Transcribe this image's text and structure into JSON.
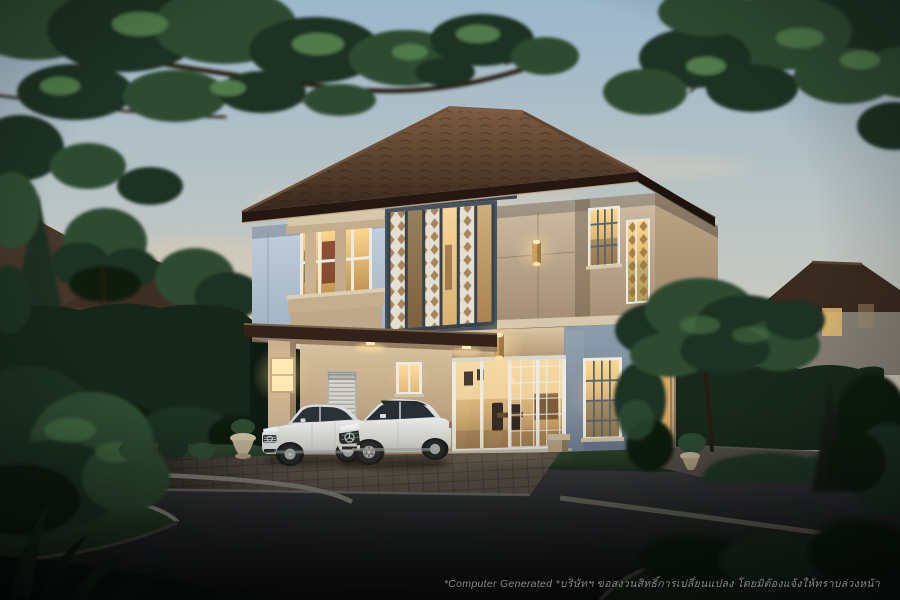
{
  "watermark": {
    "text": "*Computer Generated *บริษัทฯ ขอสงวนสิทธิ์การเปลี่ยนแปลง โดยมิต้องแจ้งให้ทราบล่วงหน้า"
  },
  "colors": {
    "sky_top": "#9cb7cb",
    "sky_mid": "#c3c8c2",
    "sky_horizon": "#e7d1b5",
    "sky_horizon_deep": "#eed8bc",
    "roof_light": "#7e5d41",
    "roof_dark": "#38271b",
    "roof_right_light": "#503a29",
    "roof_right_dark": "#241710",
    "fascia_brown": "#261811",
    "wall_blue": "#c7d3df",
    "wall_blue_deep": "#9eb0c1",
    "wall_beige": "#d1c0a6",
    "wall_beige_deep": "#a18a71",
    "wall_beige_ground": "#dcc6a4",
    "wall_beige_ground_deep": "#a98e6c",
    "wall_shadow_blue": "#8d9fae",
    "trim_light": "#d8c8ab",
    "frame_white": "#eceae2",
    "frame_dark": "#46525e",
    "lattice_screen": "#e4dfd1",
    "window_glow": "#ffd98f",
    "window_glow_deep": "#c09454",
    "interior_warm": "#f3d49a",
    "interior_deep": "#b98e55",
    "hedge_green": "#16271a",
    "tree_dark": "#1d3023",
    "tree_mid": "#2e4c33",
    "tree_light": "#4f7a48",
    "branch_brown": "#261b11",
    "grass_light": "#31492f",
    "grass_dark": "#1a2b1b",
    "road_light": "#3c3e40",
    "road_dark": "#101112",
    "curb_gray": "#82807a",
    "paver_brown": "#5a5248",
    "concrete_gray": "#55504a",
    "car_white": "#eff0ee",
    "car_gray": "#c2c7c9",
    "watermark_gray": "#949494"
  }
}
